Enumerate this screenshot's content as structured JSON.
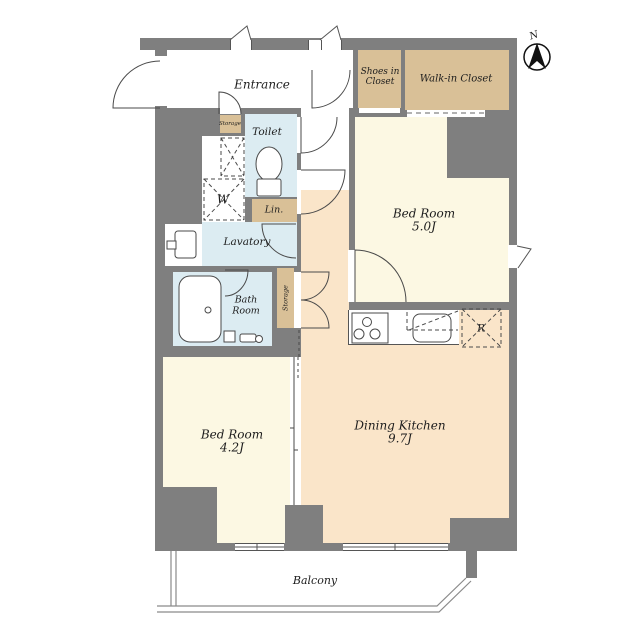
{
  "floor_plan": {
    "rooms": {
      "entrance": {
        "label": "Entrance"
      },
      "shoes_closet": {
        "line1": "Shoes in",
        "line2": "Closet"
      },
      "walkin_closet": {
        "label": "Walk-in Closet"
      },
      "toilet": {
        "label": "Toilet"
      },
      "storage_entrance": {
        "label": "Storage"
      },
      "washer": {
        "label": "W"
      },
      "linen": {
        "label": "Lin."
      },
      "lavatory": {
        "label": "Lavatory"
      },
      "bathroom": {
        "line1": "Bath",
        "line2": "Room"
      },
      "storage_hall": {
        "label": "Storage"
      },
      "bedroom_1": {
        "name": "Bed Room",
        "size": "5.0J"
      },
      "bedroom_2": {
        "name": "Bed Room",
        "size": "4.2J"
      },
      "dining_kitchen": {
        "name": "Dining Kitchen",
        "size": "9.7J"
      },
      "refrigerator": {
        "label": "R"
      },
      "balcony": {
        "label": "Balcony"
      }
    },
    "compass": {
      "label": "N"
    },
    "colors": {
      "wall": "#7f7f7f",
      "closet": "#d9c097",
      "room": "#fcf8e3",
      "living": "#fae5c9",
      "wet": "#dcecf2"
    }
  }
}
